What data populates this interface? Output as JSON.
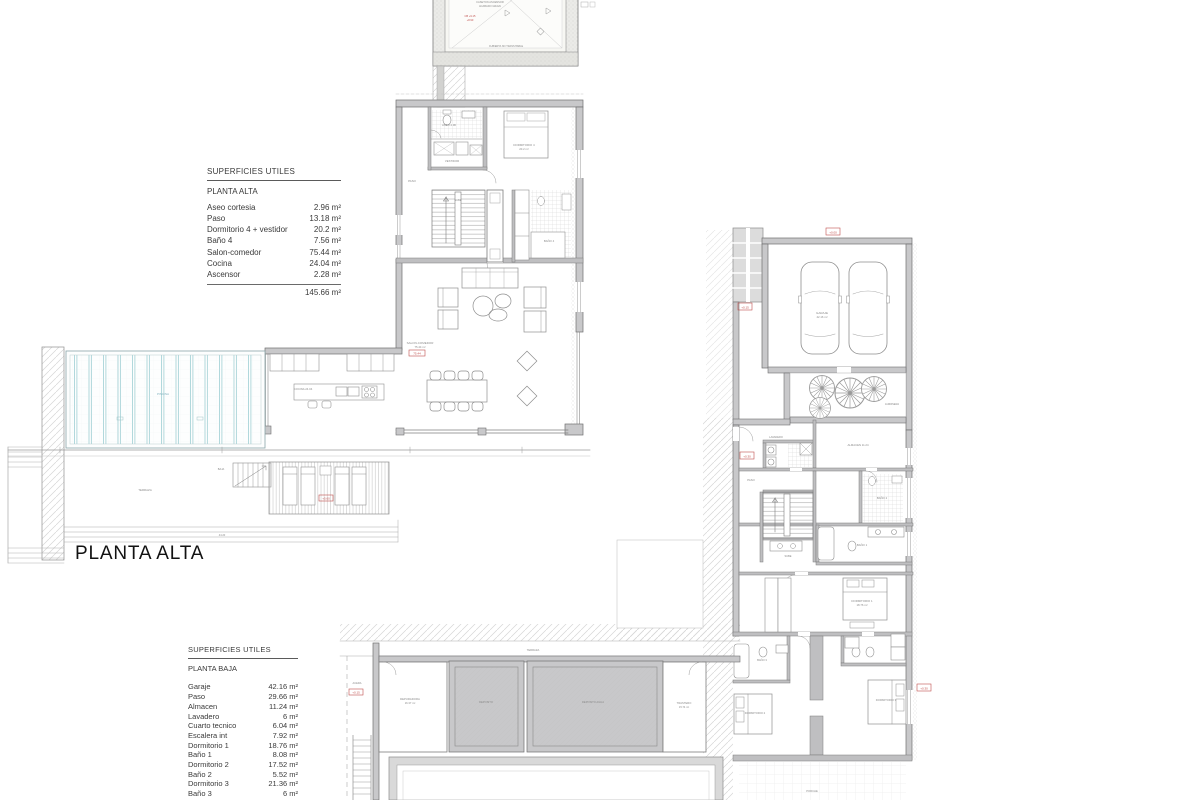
{
  "plan_title": "PLANTA ALTA",
  "colors": {
    "accent_red": "#c0504d",
    "pool_blue": "#a9d4d8",
    "wall_gray": "#c8c8ca"
  },
  "tables": {
    "alta": {
      "title": "SUPERFICIES UTILES",
      "subtitle": "PLANTA ALTA",
      "rows": [
        {
          "name": "Aseo cortesia",
          "value": "2.96 m²"
        },
        {
          "name": "Paso",
          "value": "13.18 m²"
        },
        {
          "name": "Dormitorio 4 + vestidor",
          "value": "20.2 m²"
        },
        {
          "name": "Baño 4",
          "value": "7.56 m²"
        },
        {
          "name": "Salon-comedor",
          "value": "75.44 m²"
        },
        {
          "name": "Cocina",
          "value": "24.04 m²"
        },
        {
          "name": "Ascensor",
          "value": "2.28 m²"
        }
      ],
      "total": "145.66 m²"
    },
    "baja": {
      "title": "SUPERFICIES UTILES",
      "subtitle": "PLANTA BAJA",
      "rows": [
        {
          "name": "Garaje",
          "value": "42.16 m²"
        },
        {
          "name": "Paso",
          "value": "29.66 m²"
        },
        {
          "name": "Almacen",
          "value": "11.24 m²"
        },
        {
          "name": "Lavadero",
          "value": "6 m²"
        },
        {
          "name": "Cuarto tecnico",
          "value": "6.04 m²"
        },
        {
          "name": "Escalera int",
          "value": "7.92 m²"
        },
        {
          "name": "Dormitorio 1",
          "value": "18.76 m²"
        },
        {
          "name": "Baño 1",
          "value": "8.08 m²"
        },
        {
          "name": "Dormitorio 2",
          "value": "17.52 m²"
        },
        {
          "name": "Baño 2",
          "value": "5.52 m²"
        },
        {
          "name": "Dormitorio 3",
          "value": "21.36 m²"
        },
        {
          "name": "Baño 3",
          "value": "6 m²"
        },
        {
          "name": "Trastero",
          "value": "15.74 m²"
        },
        {
          "name": "Depuradora",
          "value": "16.37 m²"
        }
      ]
    }
  },
  "plan_labels": {
    "mini-top1": {
      "x": 490,
      "y": 3,
      "t": "CASETON ASCENSOR",
      "s": 2.6
    },
    "mini-top2": {
      "x": 490,
      "y": 7,
      "t": "ACABADO GRAVA",
      "s": 2.6
    },
    "mini-red1": {
      "x": 470,
      "y": 17,
      "t": "CB +9.15",
      "s": 2.6,
      "c": "#c0504d"
    },
    "mini-red2": {
      "x": 470,
      "y": 21,
      "t": "+8.90",
      "s": 2.6,
      "c": "#c0504d"
    },
    "mini-bottom": {
      "x": 506,
      "y": 47,
      "t": "CUBIERTA NO TRANSITABLE",
      "s": 2.5
    },
    "aseo": {
      "x": 449,
      "y": 126,
      "t": "ASEO 2.96",
      "s": 2.8
    },
    "vestidor": {
      "x": 452,
      "y": 162,
      "t": "VESTIDOR",
      "s": 2.8
    },
    "dormitorio4": {
      "x": 524,
      "y": 146,
      "t": "DORMITORIO 4",
      "s": 2.9
    },
    "dormitorio4b": {
      "x": 524,
      "y": 150,
      "t": "20.2 m²",
      "s": 2.8
    },
    "paso-alta": {
      "x": 412,
      "y": 182,
      "t": "PASO",
      "s": 2.9
    },
    "sube-alta": {
      "x": 458,
      "y": 201,
      "t": "SUBE",
      "s": 2.6
    },
    "bano4": {
      "x": 549,
      "y": 242,
      "t": "BAÑO 4",
      "s": 2.8
    },
    "salon1": {
      "x": 420,
      "y": 344,
      "t": "SALON-COMEDOR",
      "s": 3
    },
    "salon2": {
      "x": 420,
      "y": 348,
      "t": "75.44 m²",
      "s": 2.8
    },
    "cocina": {
      "x": 303,
      "y": 390,
      "t": "COCINA 24.04",
      "s": 2.8
    },
    "piscina": {
      "x": 163,
      "y": 395,
      "t": "PISCINA",
      "s": 3,
      "c": "#7fb0bc"
    },
    "terraza-alta": {
      "x": 145,
      "y": 491,
      "t": "TERRAZA",
      "s": 2.9
    },
    "esc-terraza": {
      "x": 221,
      "y": 470,
      "t": "BAJA",
      "s": 2.6
    },
    "dim-terraza": {
      "x": 222,
      "y": 536,
      "t": "44.20",
      "s": 2.6
    },
    "garaje1": {
      "x": 822,
      "y": 314,
      "t": "GARAJE",
      "s": 3
    },
    "garaje2": {
      "x": 822,
      "y": 318,
      "t": "42.16 m²",
      "s": 2.8
    },
    "jardinera": {
      "x": 892,
      "y": 405,
      "t": "JARDINERA",
      "s": 2.5
    },
    "almacen": {
      "x": 858,
      "y": 446,
      "t": "ALMACEN 11.24",
      "s": 2.8
    },
    "lavadero": {
      "x": 776,
      "y": 438,
      "t": "LAVADERO",
      "s": 2.6
    },
    "paso-baja": {
      "x": 751,
      "y": 481,
      "t": "PASO",
      "s": 2.8
    },
    "bano2": {
      "x": 882,
      "y": 499,
      "t": "BAÑO 2",
      "s": 2.8
    },
    "escalera-int": {
      "x": 788,
      "y": 557,
      "t": "SUBE",
      "s": 2.6
    },
    "bano1": {
      "x": 862,
      "y": 546,
      "t": "BAÑO 1",
      "s": 2.8
    },
    "dormitorio1": {
      "x": 862,
      "y": 602,
      "t": "DORMITORIO 1",
      "s": 2.9
    },
    "dormitorio1b": {
      "x": 862,
      "y": 606,
      "t": "18.76 m²",
      "s": 2.8
    },
    "bano3": {
      "x": 762,
      "y": 661,
      "t": "BAÑO 3",
      "s": 2.7
    },
    "dormitorio2": {
      "x": 755,
      "y": 714,
      "t": "DORMITORIO 2",
      "s": 2.8
    },
    "dormitorio3": {
      "x": 886,
      "y": 701,
      "t": "DORMITORIO 3",
      "s": 2.8
    },
    "porche": {
      "x": 812,
      "y": 792,
      "t": "PORCHE",
      "s": 2.7
    },
    "terraza-baja": {
      "x": 533,
      "y": 651,
      "t": "TERRAZA",
      "s": 2.7
    },
    "depuradora": {
      "x": 410,
      "y": 700,
      "t": "DEPURADORA",
      "s": 2.8
    },
    "depuradora2": {
      "x": 410,
      "y": 704,
      "t": "16.37 m²",
      "s": 2.7
    },
    "deposito1": {
      "x": 486,
      "y": 703,
      "t": "DEPOSITO",
      "s": 2.7
    },
    "deposito2": {
      "x": 593,
      "y": 703,
      "t": "DEPOSITO AGUA",
      "s": 2.7
    },
    "trastero1": {
      "x": 684,
      "y": 704,
      "t": "TRASTERO",
      "s": 2.7
    },
    "trastero2": {
      "x": 684,
      "y": 708,
      "t": "15.74 m²",
      "s": 2.6
    },
    "acera": {
      "x": 357,
      "y": 684,
      "t": "ACERA",
      "s": 2.6
    }
  },
  "red_markers": [
    {
      "x": 826,
      "y": 228,
      "w": 14,
      "h": 7,
      "t": "+0.00"
    },
    {
      "x": 738,
      "y": 303,
      "w": 14,
      "h": 7,
      "t": "+0.15"
    },
    {
      "x": 740,
      "y": 452,
      "w": 14,
      "h": 7,
      "t": "+0.30"
    },
    {
      "x": 917,
      "y": 684,
      "w": 14,
      "h": 7,
      "t": "+0.30"
    },
    {
      "x": 409,
      "y": 350,
      "w": 16,
      "h": 6,
      "t": "75.44"
    },
    {
      "x": 319,
      "y": 495,
      "w": 14,
      "h": 6,
      "t": "+5.60"
    },
    {
      "x": 349,
      "y": 689,
      "w": 14,
      "h": 6,
      "t": "+0.15"
    }
  ]
}
